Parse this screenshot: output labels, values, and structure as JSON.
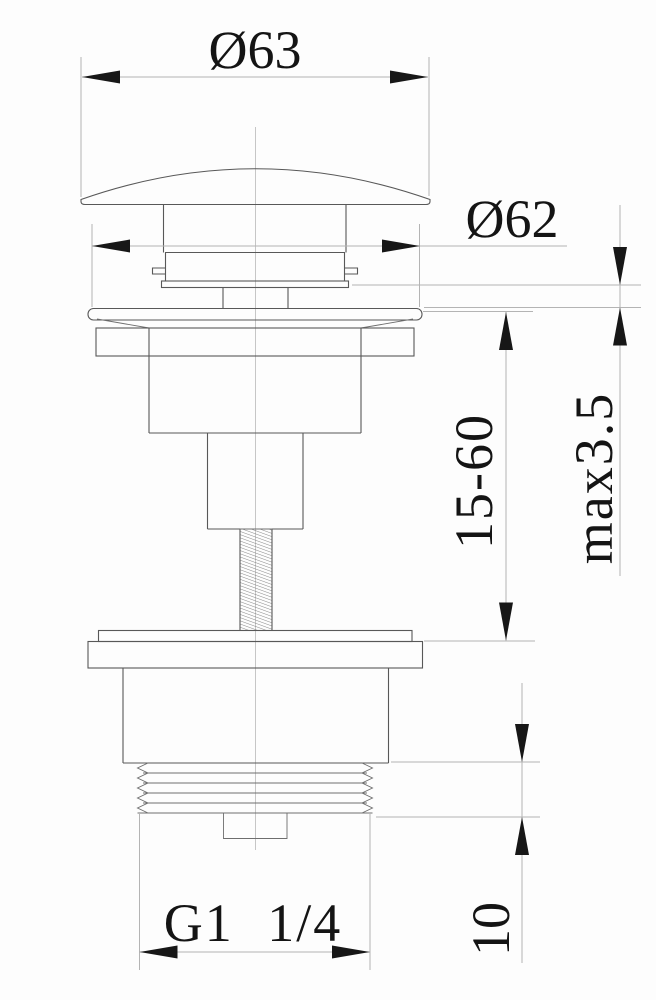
{
  "drawing": {
    "labels": {
      "cap_diameter": "Ø63",
      "flange_diameter": "Ø62",
      "flange_max_thickness": "max3.5",
      "height_range": "15-60",
      "thread_length": "10",
      "thread_size": "G1 1/4"
    }
  }
}
